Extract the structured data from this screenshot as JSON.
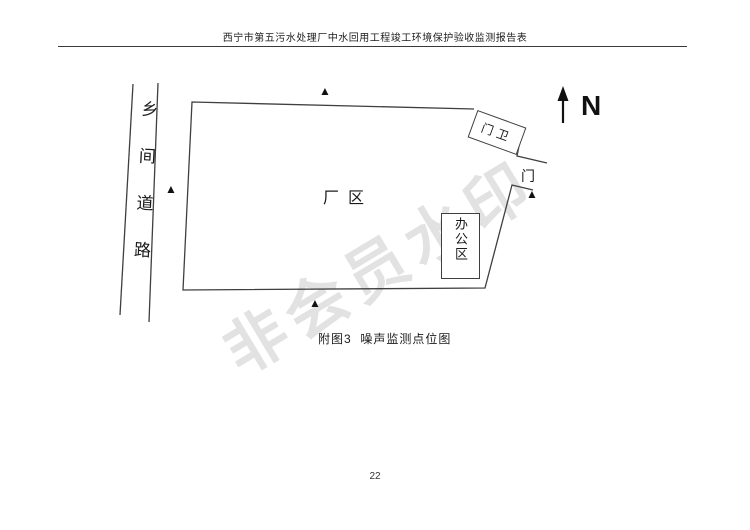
{
  "page": {
    "header_title": "西宁市第五污水处理厂中水回用工程竣工环境保护验收监测报告表",
    "page_number": "22",
    "watermark_text": "非会员水印"
  },
  "diagram": {
    "caption": "附图3  噪声监测点位图",
    "north_label": "N",
    "road_label": "乡间道路",
    "factory_label": "厂区",
    "office_label": "办公区",
    "gatehouse_label": "门卫",
    "gate_label": "门",
    "marker_glyph": "▲",
    "colors": {
      "line": "#3f3f3f",
      "ink": "#1a1a1a",
      "watermark": "#e2e2e2"
    }
  }
}
